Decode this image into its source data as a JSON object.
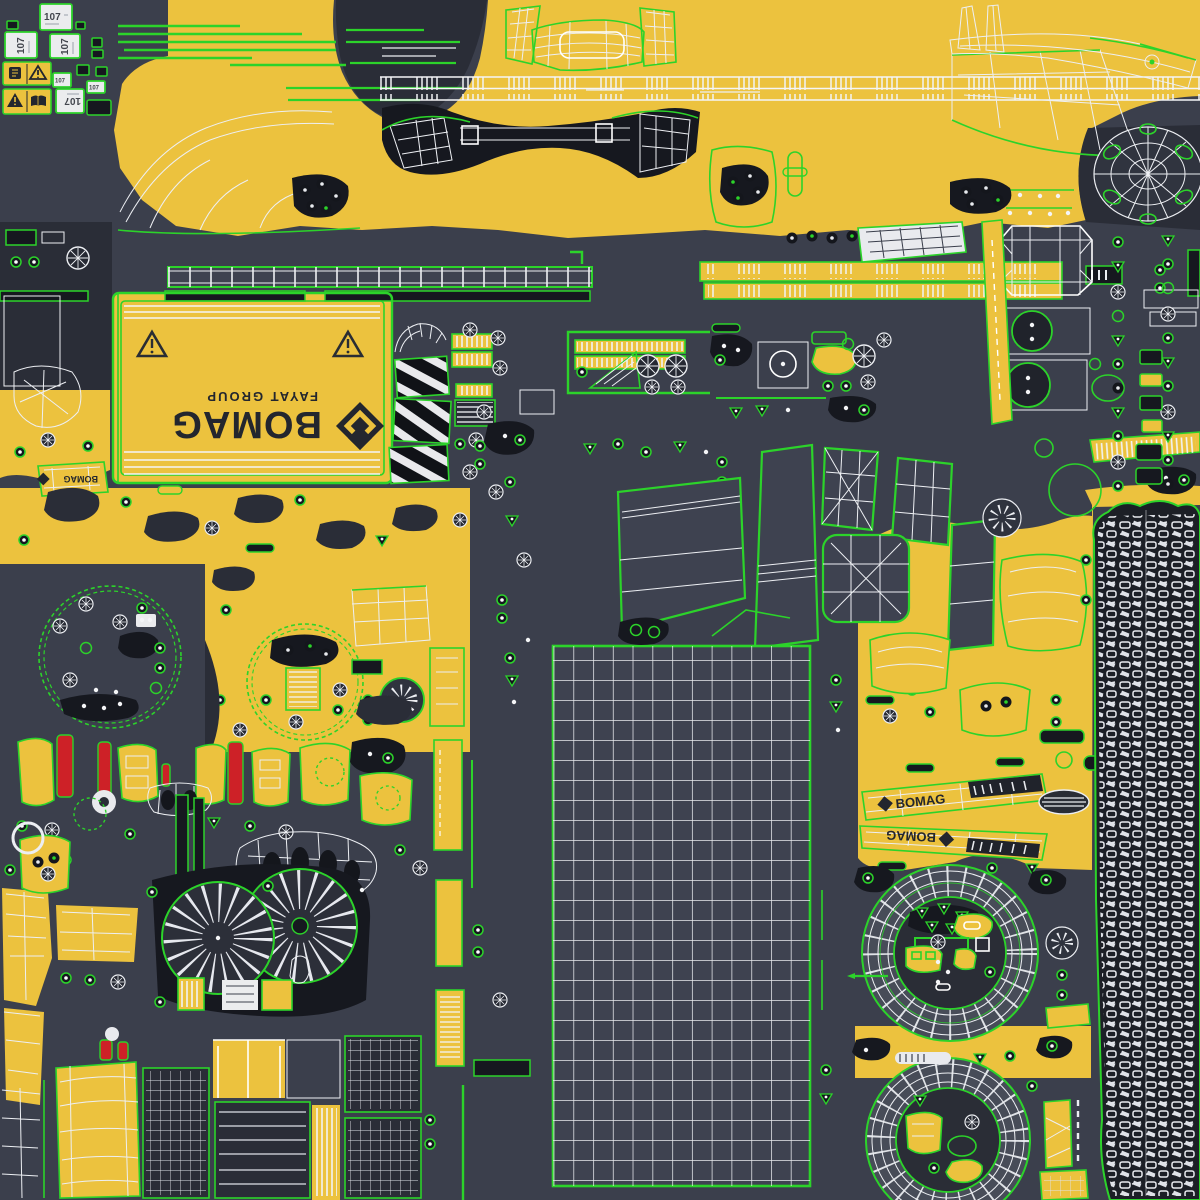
{
  "colors": {
    "background": "#3b3f4c",
    "background_deep": "#16181f",
    "panel_dark": "#2a2d37",
    "panel_grid": "#3e4250",
    "yellow": "#ecc23e",
    "green": "#2cd32a",
    "white_line": "#edeff3",
    "red": "#cd2127",
    "ring_gray": "#4b505c",
    "sticker": "#ebecee",
    "ink": "#23262e"
  },
  "branding": {
    "wordmark": "BOMAG",
    "subtitle": "FAYAT GROUP"
  },
  "decals": {
    "sticker_107": "107"
  },
  "side_panels": {
    "brand": "BOMAG"
  },
  "counts": {
    "sticker_107_instances": "6",
    "center_grid_columns": "13",
    "center_grid_rows": "27",
    "fan_discs": "2",
    "drum_faces": "2"
  }
}
